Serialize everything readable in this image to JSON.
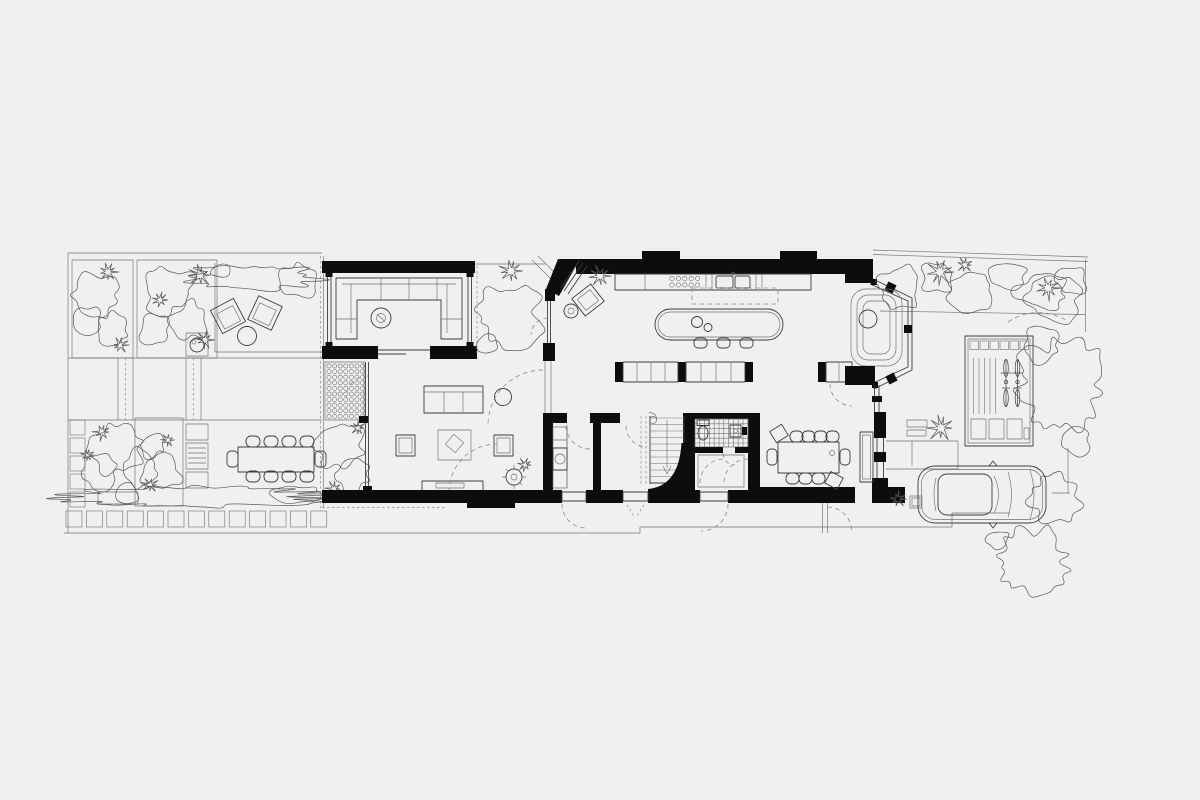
{
  "document": {
    "type": "architectural-floor-plan",
    "view": "ground-floor-and-garden-site-plan"
  },
  "colors": {
    "background": "#f0f0ee",
    "line": "#3d3d3d",
    "line-soft": "#6f6f6f",
    "line-dash": "#8a8a8a",
    "wall": "#0d0d0d",
    "foliage": "#585858"
  },
  "legend": {
    "rear_garden": [
      "planted-beds",
      "hedges",
      "lounge-chairs",
      "coffee-table",
      "barbecue",
      "garden-paths",
      "paving-slabs",
      "outdoor-kitchen",
      "outdoor-dining-table",
      "bench"
    ],
    "garden_room": [
      "u-shaped-sofa",
      "round-side-table",
      "sliding-doors",
      "glazed-walls"
    ],
    "living_room": [
      "sofa",
      "armchairs",
      "rug",
      "tv-unit",
      "wood-stove",
      "round-side-table",
      "door-swing-arcs",
      "circle-paving"
    ],
    "hall_block": [
      "utility-room",
      "washing-machine",
      "staircase",
      "curved-wall",
      "bathroom",
      "toilet",
      "basin",
      "tiled-floor",
      "doorways"
    ],
    "kitchen": [
      "worktop",
      "hob",
      "sink",
      "kitchen-island",
      "bar-stools",
      "low-cabinets",
      "rooflight-outline",
      "bay-window",
      "window-seat",
      "armchair",
      "side-table"
    ],
    "dining": [
      "dining-table",
      "dining-chairs",
      "window-seat",
      "front-porch",
      "planter-pot"
    ],
    "front_garden": [
      "planted-border",
      "bike-store",
      "bicycles",
      "stepping-stones",
      "front-path",
      "gate-swing",
      "car",
      "driveway",
      "shrubs",
      "site-boundary"
    ]
  }
}
